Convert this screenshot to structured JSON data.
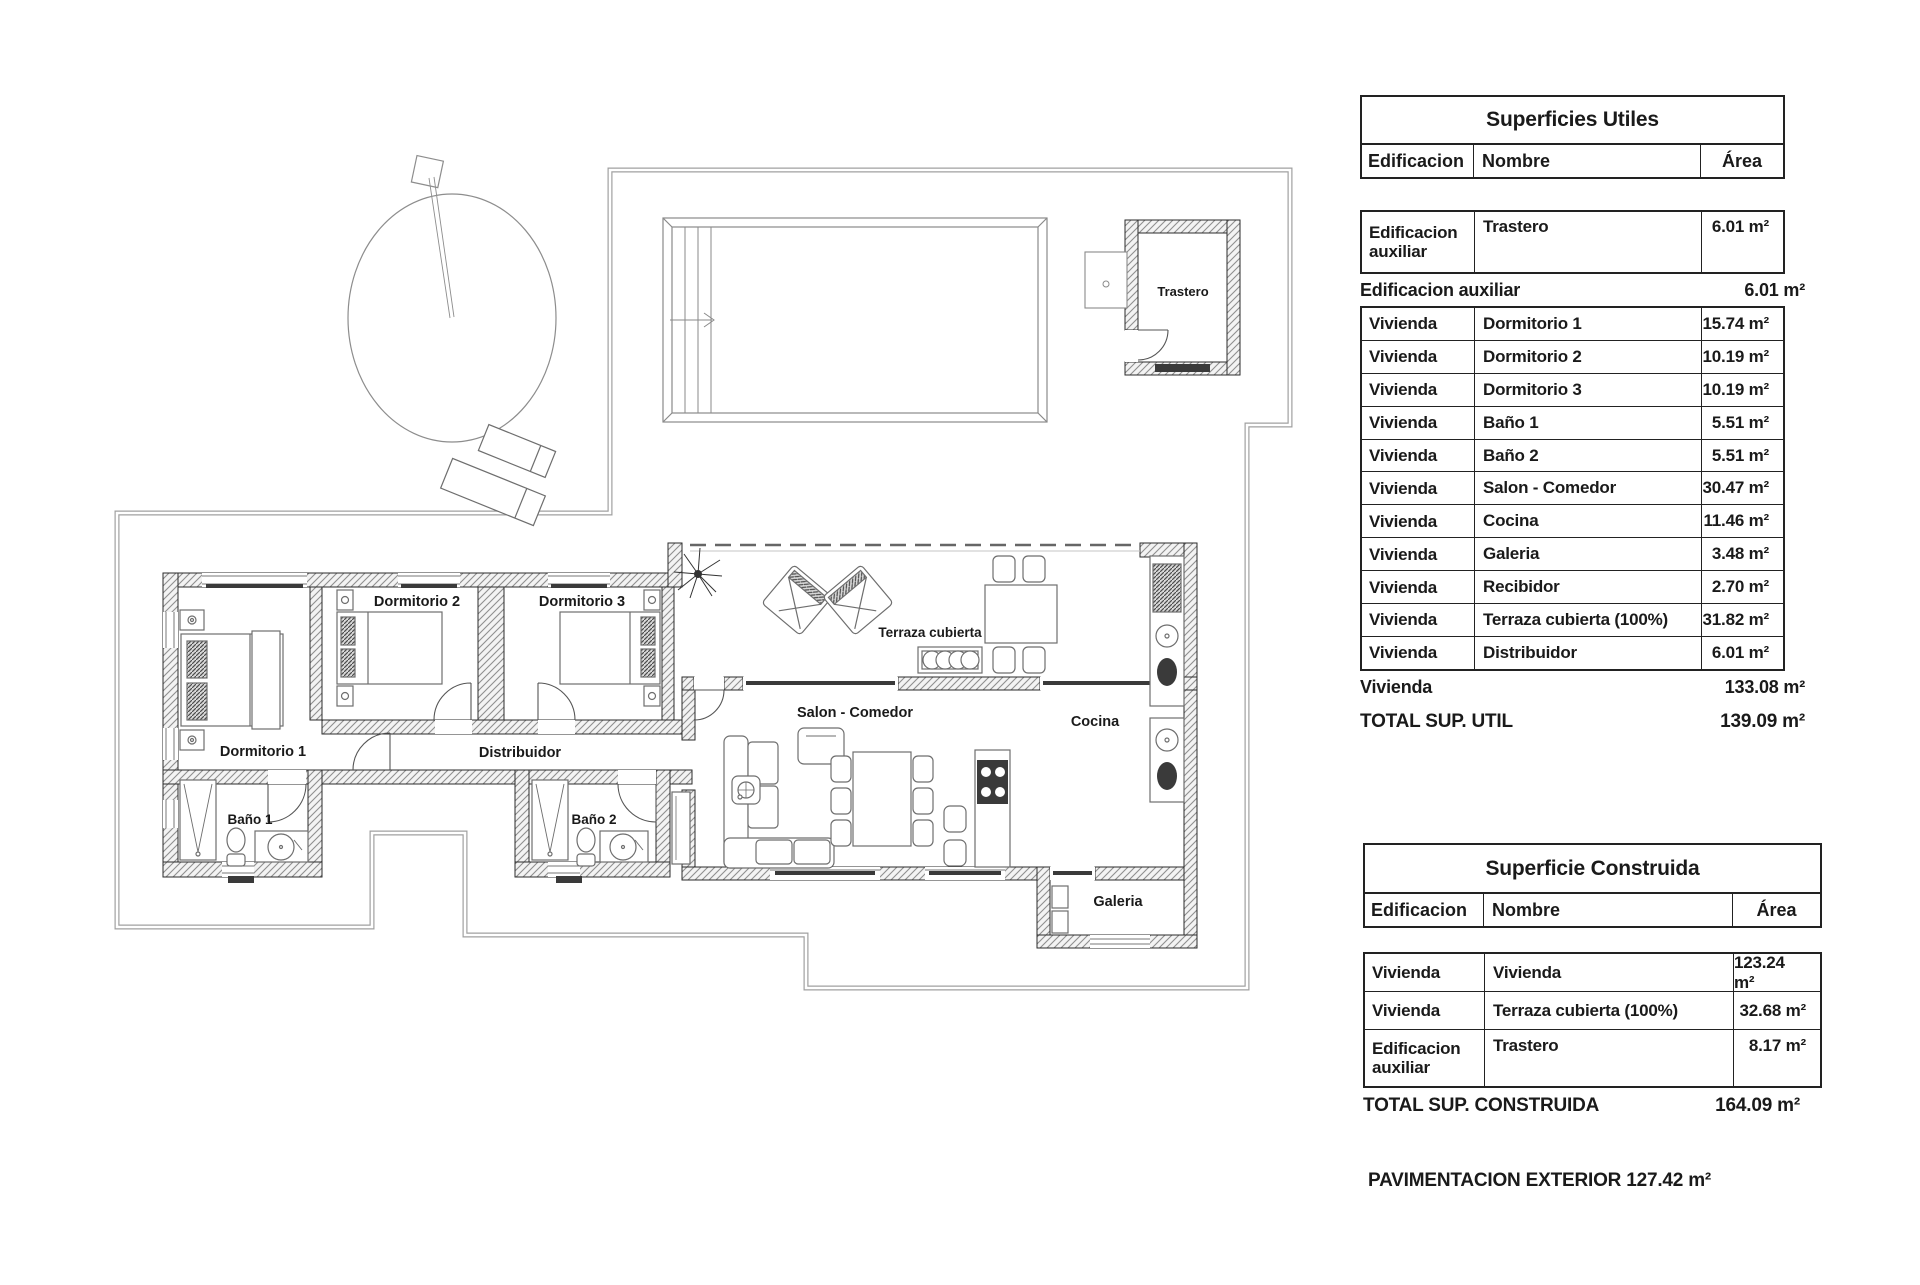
{
  "plan": {
    "labels": {
      "dormitorio1": "Dormitorio 1",
      "dormitorio2": "Dormitorio 2",
      "dormitorio3": "Dormitorio 3",
      "banyo1": "Baño 1",
      "banyo2": "Baño 2",
      "distribuidor": "Distribuidor",
      "salon": "Salon - Comedor",
      "cocina": "Cocina",
      "galeria": "Galeria",
      "terraza": "Terraza cubierta",
      "trastero": "Trastero"
    }
  },
  "colors": {
    "ink": "#1a1a1a",
    "wall": "#2b2b2b",
    "hatch": "#8f8f8f",
    "boundary": "#a0a0a0",
    "furniture": "#6e6e6e",
    "dark": "#3a3a3a"
  },
  "tables": {
    "utiles": {
      "title": "Superficies Utiles",
      "headers": {
        "edificacion": "Edificacion",
        "nombre": "Nombre",
        "area": "Área"
      },
      "aux_row": {
        "edificacion": "Edificacion auxiliar",
        "nombre": "Trastero",
        "area": "6.01 m²"
      },
      "aux_subtotal": {
        "label": "Edificacion auxiliar",
        "value": "6.01 m²"
      },
      "rows": [
        {
          "edificacion": "Vivienda",
          "nombre": "Dormitorio 1",
          "area": "15.74 m²"
        },
        {
          "edificacion": "Vivienda",
          "nombre": "Dormitorio 2",
          "area": "10.19 m²"
        },
        {
          "edificacion": "Vivienda",
          "nombre": "Dormitorio 3",
          "area": "10.19 m²"
        },
        {
          "edificacion": "Vivienda",
          "nombre": "Baño 1",
          "area": "5.51 m²"
        },
        {
          "edificacion": "Vivienda",
          "nombre": "Baño 2",
          "area": "5.51 m²"
        },
        {
          "edificacion": "Vivienda",
          "nombre": "Salon - Comedor",
          "area": "30.47 m²"
        },
        {
          "edificacion": "Vivienda",
          "nombre": "Cocina",
          "area": "11.46 m²"
        },
        {
          "edificacion": "Vivienda",
          "nombre": "Galeria",
          "area": "3.48 m²"
        },
        {
          "edificacion": "Vivienda",
          "nombre": "Recibidor",
          "area": "2.70 m²"
        },
        {
          "edificacion": "Vivienda",
          "nombre": "Terraza cubierta (100%)",
          "area": "31.82 m²"
        },
        {
          "edificacion": "Vivienda",
          "nombre": "Distribuidor",
          "area": "6.01 m²"
        }
      ],
      "vivienda_subtotal": {
        "label": "Vivienda",
        "value": "133.08 m²"
      },
      "total": {
        "label": "TOTAL SUP. UTIL",
        "value": "139.09 m²"
      }
    },
    "construida": {
      "title": "Superficie Construida",
      "headers": {
        "edificacion": "Edificacion",
        "nombre": "Nombre",
        "area": "Área"
      },
      "rows": [
        {
          "edificacion": "Vivienda",
          "nombre": "Vivienda",
          "area": "123.24 m²"
        },
        {
          "edificacion": "Vivienda",
          "nombre": "Terraza cubierta (100%)",
          "area": "32.68 m²"
        },
        {
          "edificacion": "Edificacion auxiliar",
          "nombre": "Trastero",
          "area": "8.17 m²",
          "tall": true
        }
      ],
      "total": {
        "label": "TOTAL SUP. CONSTRUIDA",
        "value": "164.09 m²"
      }
    },
    "footer": "PAVIMENTACION EXTERIOR 127.42 m²"
  }
}
